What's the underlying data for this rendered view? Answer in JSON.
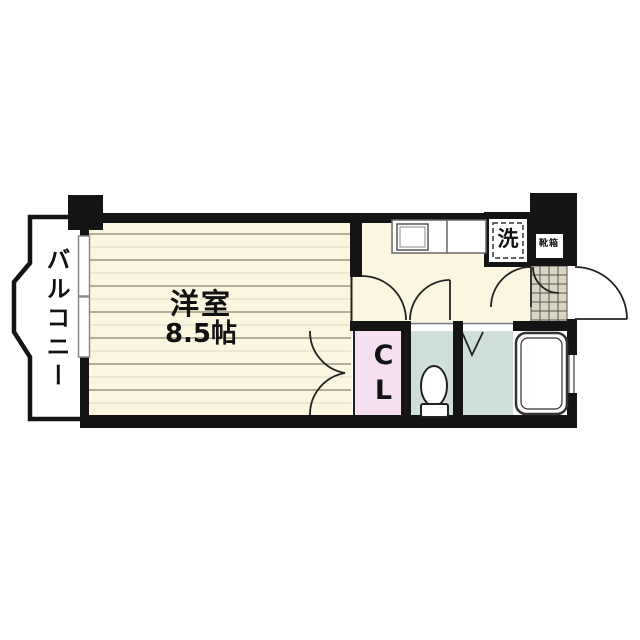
{
  "plan": {
    "labels": {
      "balcony": "バルコニー",
      "room_name": "洋室",
      "room_size": "8.5帖",
      "closet": "CL",
      "washer": "洗",
      "shoebox": "靴箱"
    },
    "colors": {
      "wall": "#141414",
      "room_floor": "#faf6df",
      "floor_line": "#a8a48e",
      "closet_fill": "#f6dff0",
      "wet_area_fill": "#cfe0da",
      "entry_tile": "#d9d5c5",
      "fixture_stroke": "#333333"
    }
  }
}
